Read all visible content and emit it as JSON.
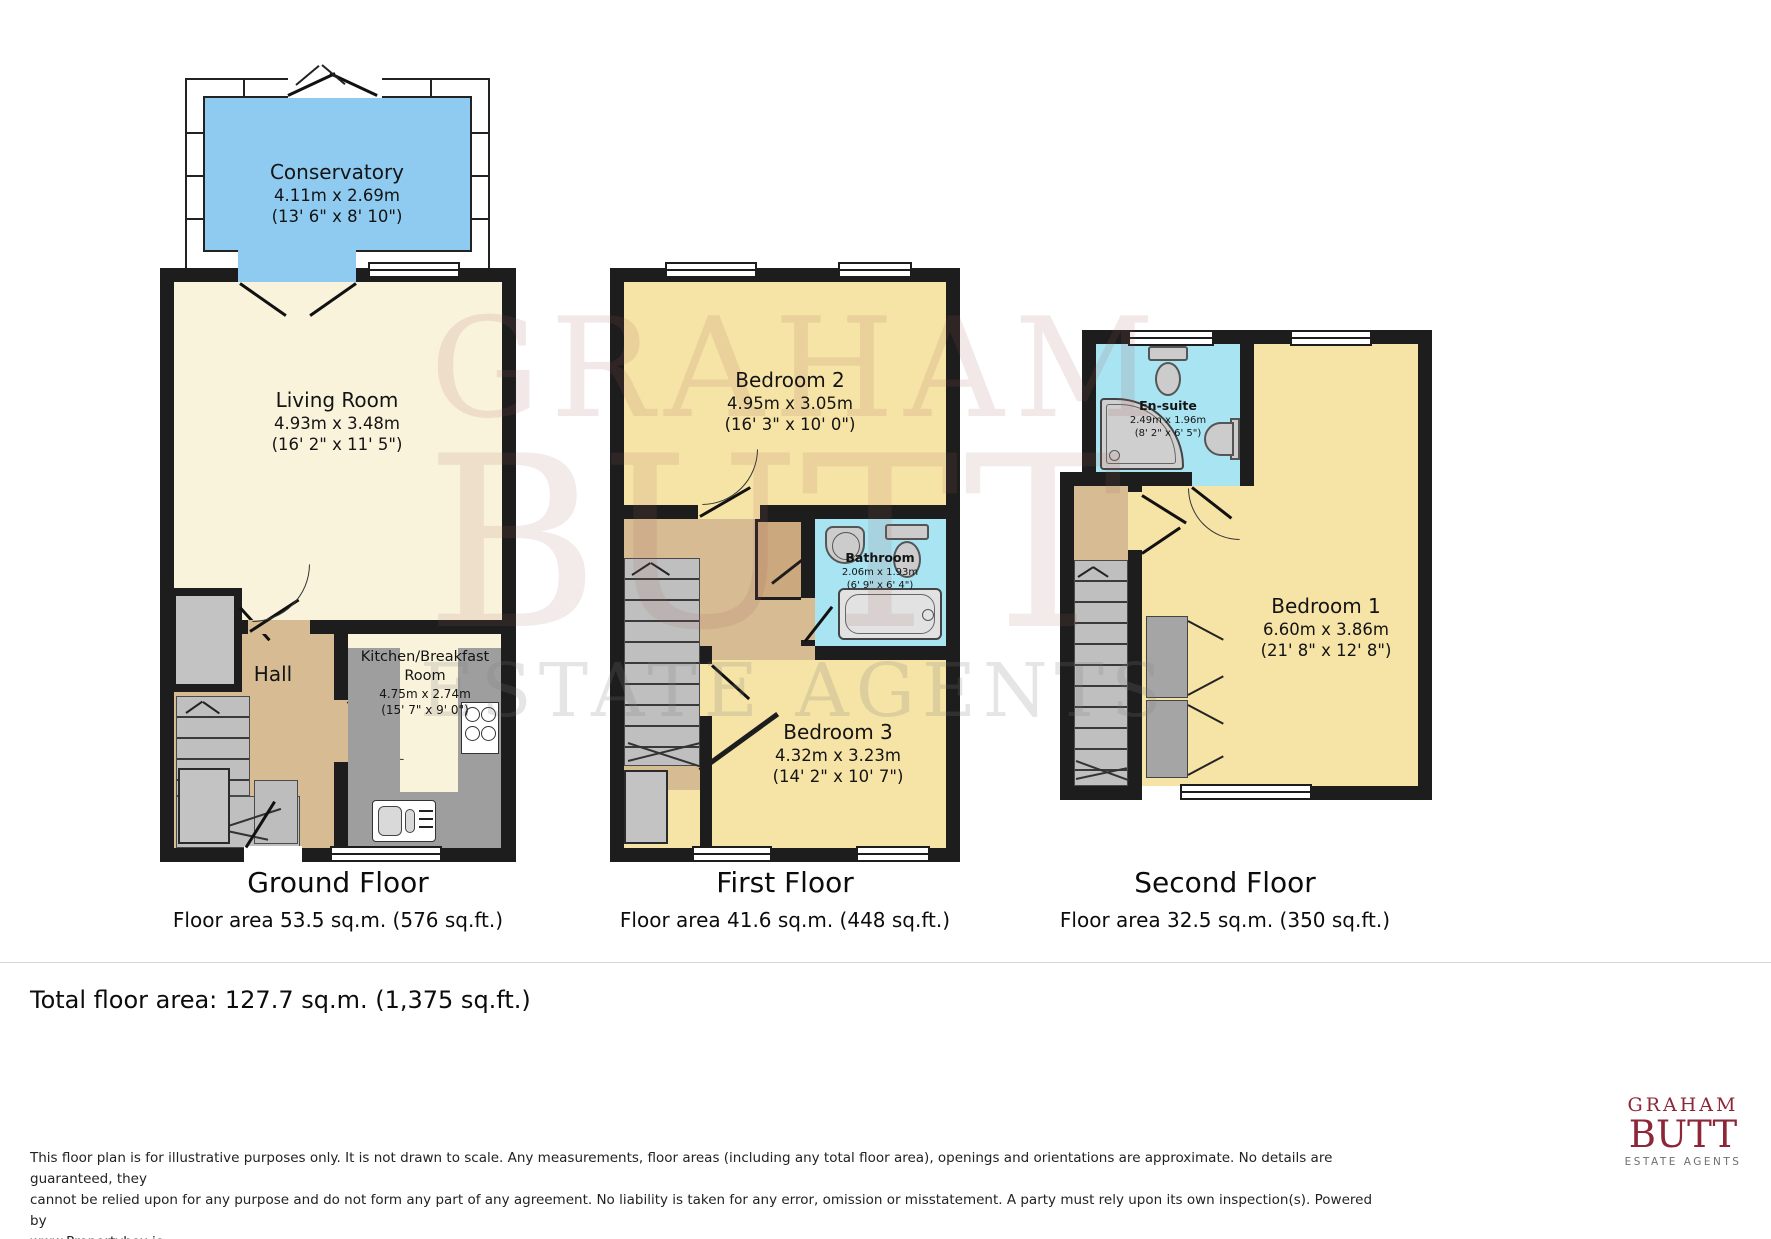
{
  "watermark": {
    "line1": "GRAHAM",
    "line2": "BUTT",
    "line3": "ESTATE AGENTS"
  },
  "floors": [
    {
      "title": "Ground Floor",
      "area_label": "Floor area 53.5 sq.m. (576 sq.ft.)"
    },
    {
      "title": "First Floor",
      "area_label": "Floor area 41.6 sq.m. (448 sq.ft.)"
    },
    {
      "title": "Second Floor",
      "area_label": "Floor area 32.5 sq.m. (350 sq.ft.)"
    }
  ],
  "rooms": {
    "conservatory": {
      "name": "Conservatory",
      "metric": "4.11m x 2.69m",
      "imperial": "(13' 6\" x 8' 10\")"
    },
    "living_room": {
      "name": "Living Room",
      "metric": "4.93m x 3.48m",
      "imperial": "(16' 2\" x 11' 5\")"
    },
    "kitchen": {
      "name": "Kitchen/Breakfast Room",
      "metric": "4.75m x 2.74m",
      "imperial": "(15' 7\" x 9' 0\")"
    },
    "hall": {
      "name": "Hall"
    },
    "bedroom2": {
      "name": "Bedroom 2",
      "metric": "4.95m x 3.05m",
      "imperial": "(16' 3\" x 10' 0\")"
    },
    "bathroom": {
      "name": "Bathroom",
      "metric": "2.06m x 1.93m",
      "imperial": "(6' 9\" x 6' 4\")"
    },
    "bedroom3": {
      "name": "Bedroom 3",
      "metric": "4.32m x 3.23m",
      "imperial": "(14' 2\" x 10' 7\")"
    },
    "ensuite": {
      "name": "En-suite",
      "metric": "2.49m x 1.96m",
      "imperial": "(8' 2\" x 6' 5\")"
    },
    "bedroom1": {
      "name": "Bedroom 1",
      "metric": "6.60m x 3.86m",
      "imperial": "(21' 8\" x 12' 8\")"
    }
  },
  "footer": {
    "total": "Total floor area: 127.7 sq.m. (1,375 sq.ft.)",
    "disclaimer_line1": "This floor plan is for illustrative purposes only. It is not drawn to scale. Any measurements, floor areas (including any total floor area), openings and orientations are approximate. No details are guaranteed, they",
    "disclaimer_line2": "cannot be relied upon for any purpose and do not form any part of any agreement. No liability is taken for any error, omission or misstatement. A party must rely upon its own inspection(s). Powered by",
    "disclaimer_line3": "www.Propertybox.io"
  },
  "logo": {
    "line1": "GRAHAM",
    "line2": "BUTT",
    "line3": "ESTATE AGENTS"
  },
  "colors": {
    "wall": "#1d1d1d",
    "room_cream": "#faf3dc",
    "room_yellow": "#f6e3a6",
    "room_tan": "#d6bb93",
    "conservatory_blue": "#8fcbf0",
    "bath_blue": "#a9e4f2",
    "fixture_gray": "#c7c7c7",
    "logo_red": "#8c2638",
    "watermark_red": "rgba(160,90,90,0.14)"
  }
}
